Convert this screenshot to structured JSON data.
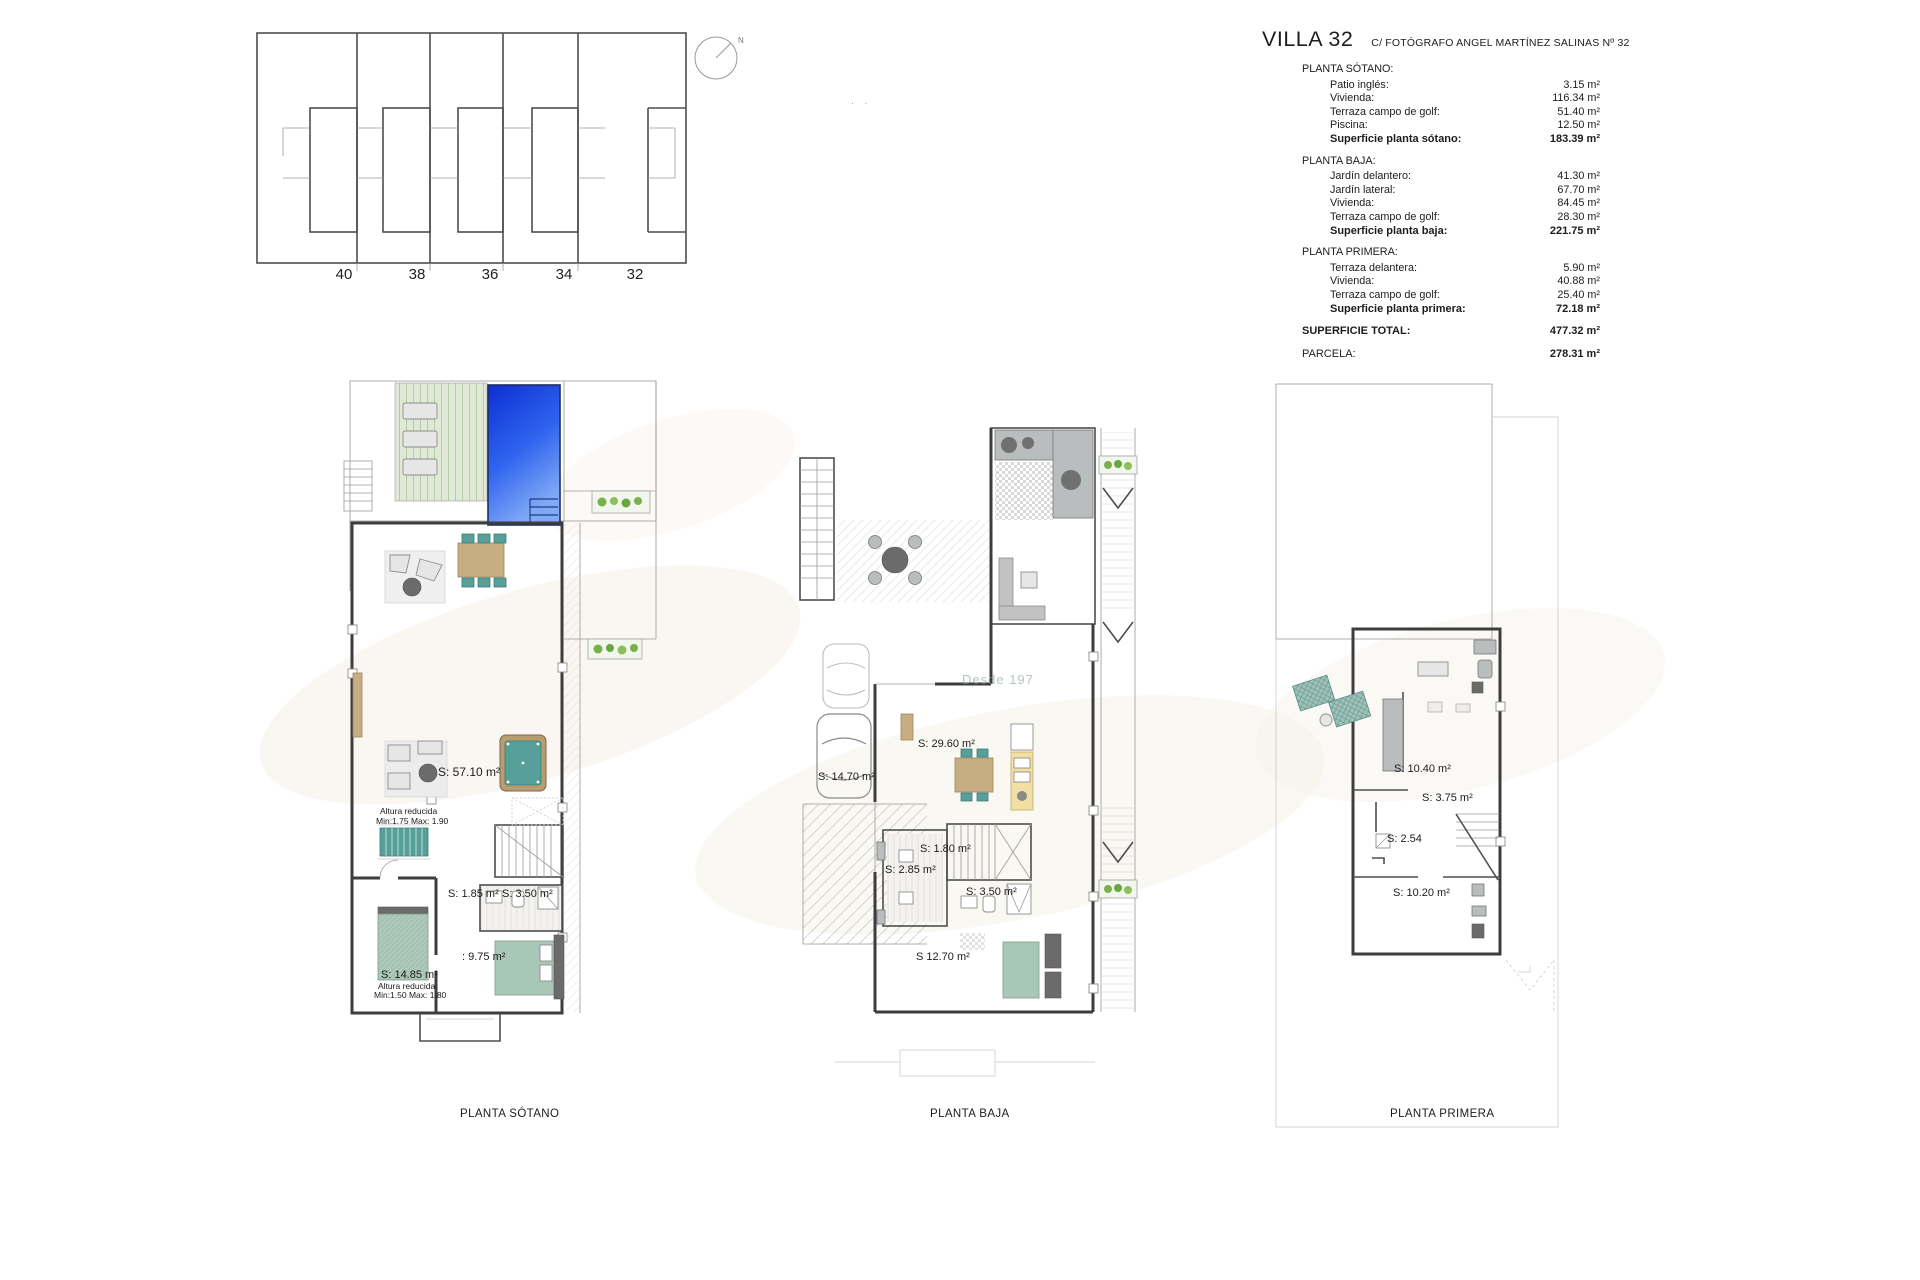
{
  "site_plan": {
    "lot_numbers": [
      "40",
      "38",
      "36",
      "34",
      "32"
    ],
    "compass_label": "N",
    "stray_marks": "· ·"
  },
  "title_block": {
    "title": "VILLA 32",
    "address": "C/ FOTÓGRAFO ANGEL MARTÍNEZ SALINAS Nº 32",
    "sections": [
      {
        "heading": "PLANTA SÓTANO:",
        "rows": [
          {
            "label": "Patio inglés:",
            "value": "3.15 m²"
          },
          {
            "label": "Vivienda:",
            "value": "116.34 m²"
          },
          {
            "label": "Terraza campo de golf:",
            "value": "51.40 m²"
          },
          {
            "label": "Piscina:",
            "value": "12.50 m²"
          }
        ],
        "total_label": "Superficie planta sótano:",
        "total_value": "183.39 m²"
      },
      {
        "heading": "PLANTA BAJA:",
        "rows": [
          {
            "label": "Jardín delantero:",
            "value": "41.30 m²"
          },
          {
            "label": "Jardín lateral:",
            "value": "67.70 m²"
          },
          {
            "label": "Vivienda:",
            "value": "84.45 m²"
          },
          {
            "label": "Terraza campo de golf:",
            "value": "28.30 m²"
          }
        ],
        "total_label": "Superficie planta baja:",
        "total_value": "221.75 m²"
      },
      {
        "heading": "PLANTA PRIMERA:",
        "rows": [
          {
            "label": "Terraza delantera:",
            "value": "5.90 m²"
          },
          {
            "label": "Vivienda:",
            "value": "40.88 m²"
          },
          {
            "label": "Terraza campo de golf:",
            "value": "25.40 m²"
          }
        ],
        "total_label": "Superficie planta primera:",
        "total_value": "72.18 m²"
      }
    ],
    "grand_totals": [
      {
        "label": "SUPERFICIE TOTAL:",
        "value": "477.32 m²"
      },
      {
        "label": "PARCELA:",
        "value": "278.31 m²"
      }
    ]
  },
  "plans": {
    "sotano": {
      "caption": "PLANTA SÓTANO",
      "labels": [
        "S: 57.10 m²",
        "Altura reducida",
        "Min:1.75 Max: 1.90",
        "S: 1.85 m²",
        "S: 3.50 m²",
        ": 9.75 m²",
        "S: 14.85 m²",
        "Altura reducida",
        "Min:1.50 Max: 1.80"
      ]
    },
    "baja": {
      "caption": "PLANTA BAJA",
      "watermark": "Desde 197",
      "labels": [
        "S: 29.60 m²",
        "S: 14.70 m²",
        "S: 1.80 m²",
        "S: 2.85 m²",
        "S: 3.50 m²",
        "S 12.70 m²"
      ]
    },
    "primera": {
      "caption": "PLANTA PRIMERA",
      "labels": [
        "S: 10.40 m²",
        "S: 3.75 m²",
        "S: 2.54",
        "S: 10.20 m²"
      ]
    }
  },
  "colors": {
    "pool_blue": "#2c5cea",
    "deck_green": "#dfe9d5",
    "furniture_teal": "#57a09a",
    "bed_green": "#a9c7b6",
    "wood_tan": "#c7ad82",
    "wall_gray": "#3d3d3d",
    "kitchen_yellow": "#f3dfa4",
    "plant_green": "#79b04a"
  }
}
